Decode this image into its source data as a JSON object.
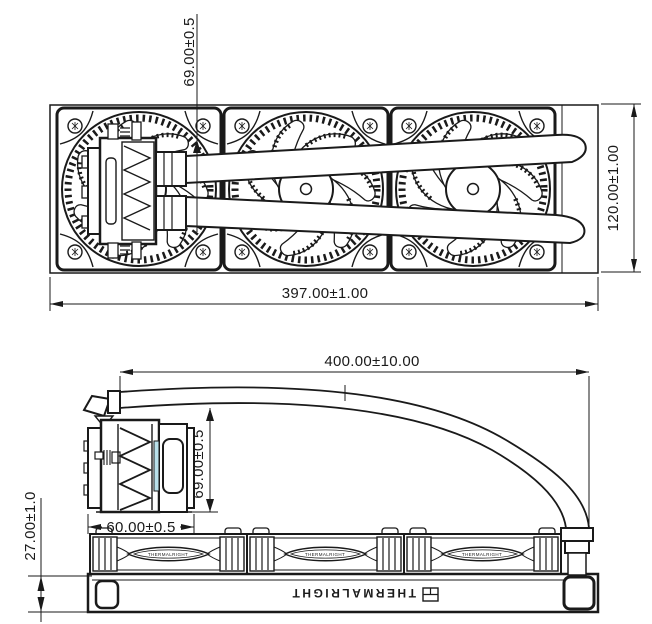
{
  "top_view": {
    "dim_pump_offset": "69.00±0.5",
    "dim_radiator_width": "120.00±1.00",
    "dim_radiator_length": "397.00±1.00"
  },
  "side_view": {
    "dim_tube_length": "400.00±10.00",
    "dim_pump_height": "69.00±0.5",
    "dim_pump_length": "60.00±0.5",
    "dim_radiator_thickness": "27.00±1.0",
    "radiator_brand": "THERMALRIGHT",
    "fan_side_label": "THERMALRIGHT"
  },
  "colors": {
    "line": "#1a1a1a",
    "accent_strip": "#b9e0ea",
    "background": "#ffffff"
  }
}
